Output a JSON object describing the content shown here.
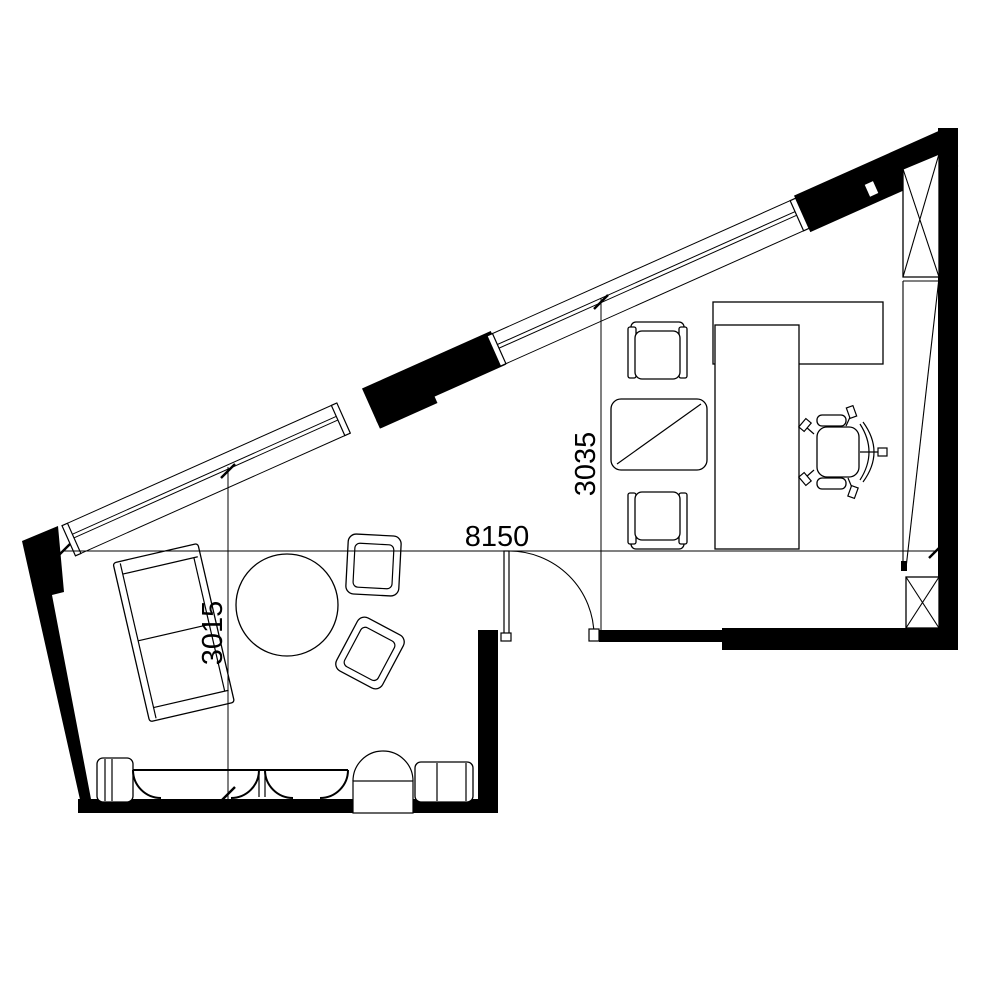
{
  "page": {
    "background_color": "#ffffff",
    "line_color": "#000000",
    "wall_fill_color": "#000000"
  },
  "floor_plan": {
    "dimensions": {
      "overall_width_label": "8150",
      "lounge_depth_label": "3015",
      "office_depth_label": "3035"
    }
  }
}
